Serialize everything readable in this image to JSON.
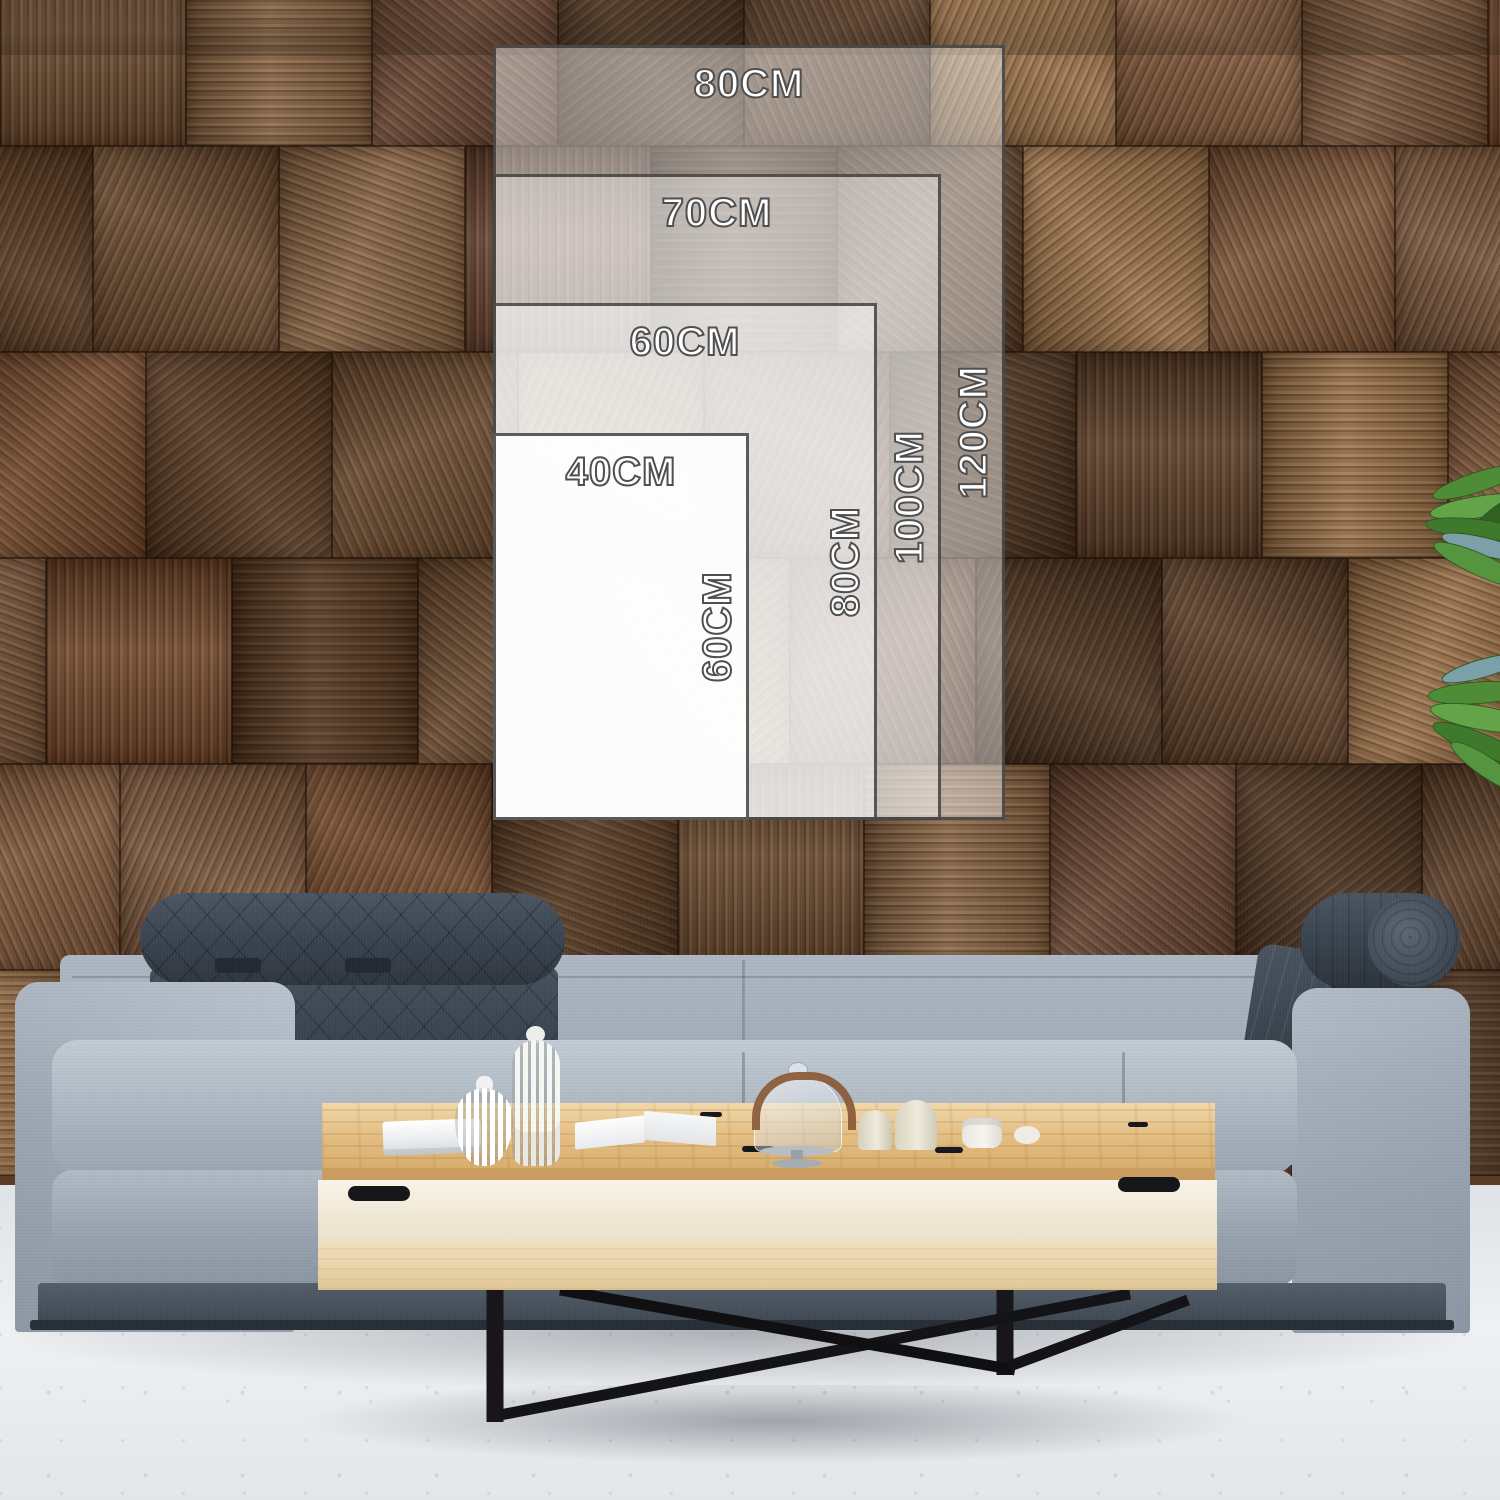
{
  "size_guide": {
    "unit": "CM",
    "sizes": [
      {
        "width_label": "80CM",
        "height_label": "120CM",
        "width_cm": 80,
        "height_cm": 120
      },
      {
        "width_label": "70CM",
        "height_label": "100CM",
        "width_cm": 70,
        "height_cm": 100
      },
      {
        "width_label": "60CM",
        "height_label": "80CM",
        "width_cm": 60,
        "height_cm": 80
      },
      {
        "width_label": "40CM",
        "height_label": "60CM",
        "width_cm": 40,
        "height_cm": 60
      }
    ],
    "label_text_color": "#ffffff",
    "label_outline_color": "#4f4f4f",
    "overlay_fill_color": "#ffffff",
    "overlay_border_color": "#383838"
  },
  "scene": {
    "wall": {
      "material": "wood-block-tiles",
      "palette": [
        "#6b4a2e",
        "#7a563a",
        "#5d3f28",
        "#8a6543",
        "#74492b",
        "#9c7248",
        "#684430",
        "#55371f",
        "#82593a",
        "#49301c"
      ]
    },
    "floor": {
      "color_top": "#dfe3e7",
      "color_bottom": "#e3e7ea"
    },
    "sofa": {
      "fabric_color": "#a7b2bd",
      "headrest_color": "#39434f",
      "base_color": "#3d4751"
    },
    "coffee_table": {
      "top_color": "#e3bd82",
      "body_color": "#f0e5d0",
      "leg_color": "#18161a"
    },
    "plant": {
      "leaf_colors": [
        "#4f8c38",
        "#63a449",
        "#3f7a2c",
        "#569540",
        "#7da0a8",
        "#2f6123"
      ]
    }
  }
}
